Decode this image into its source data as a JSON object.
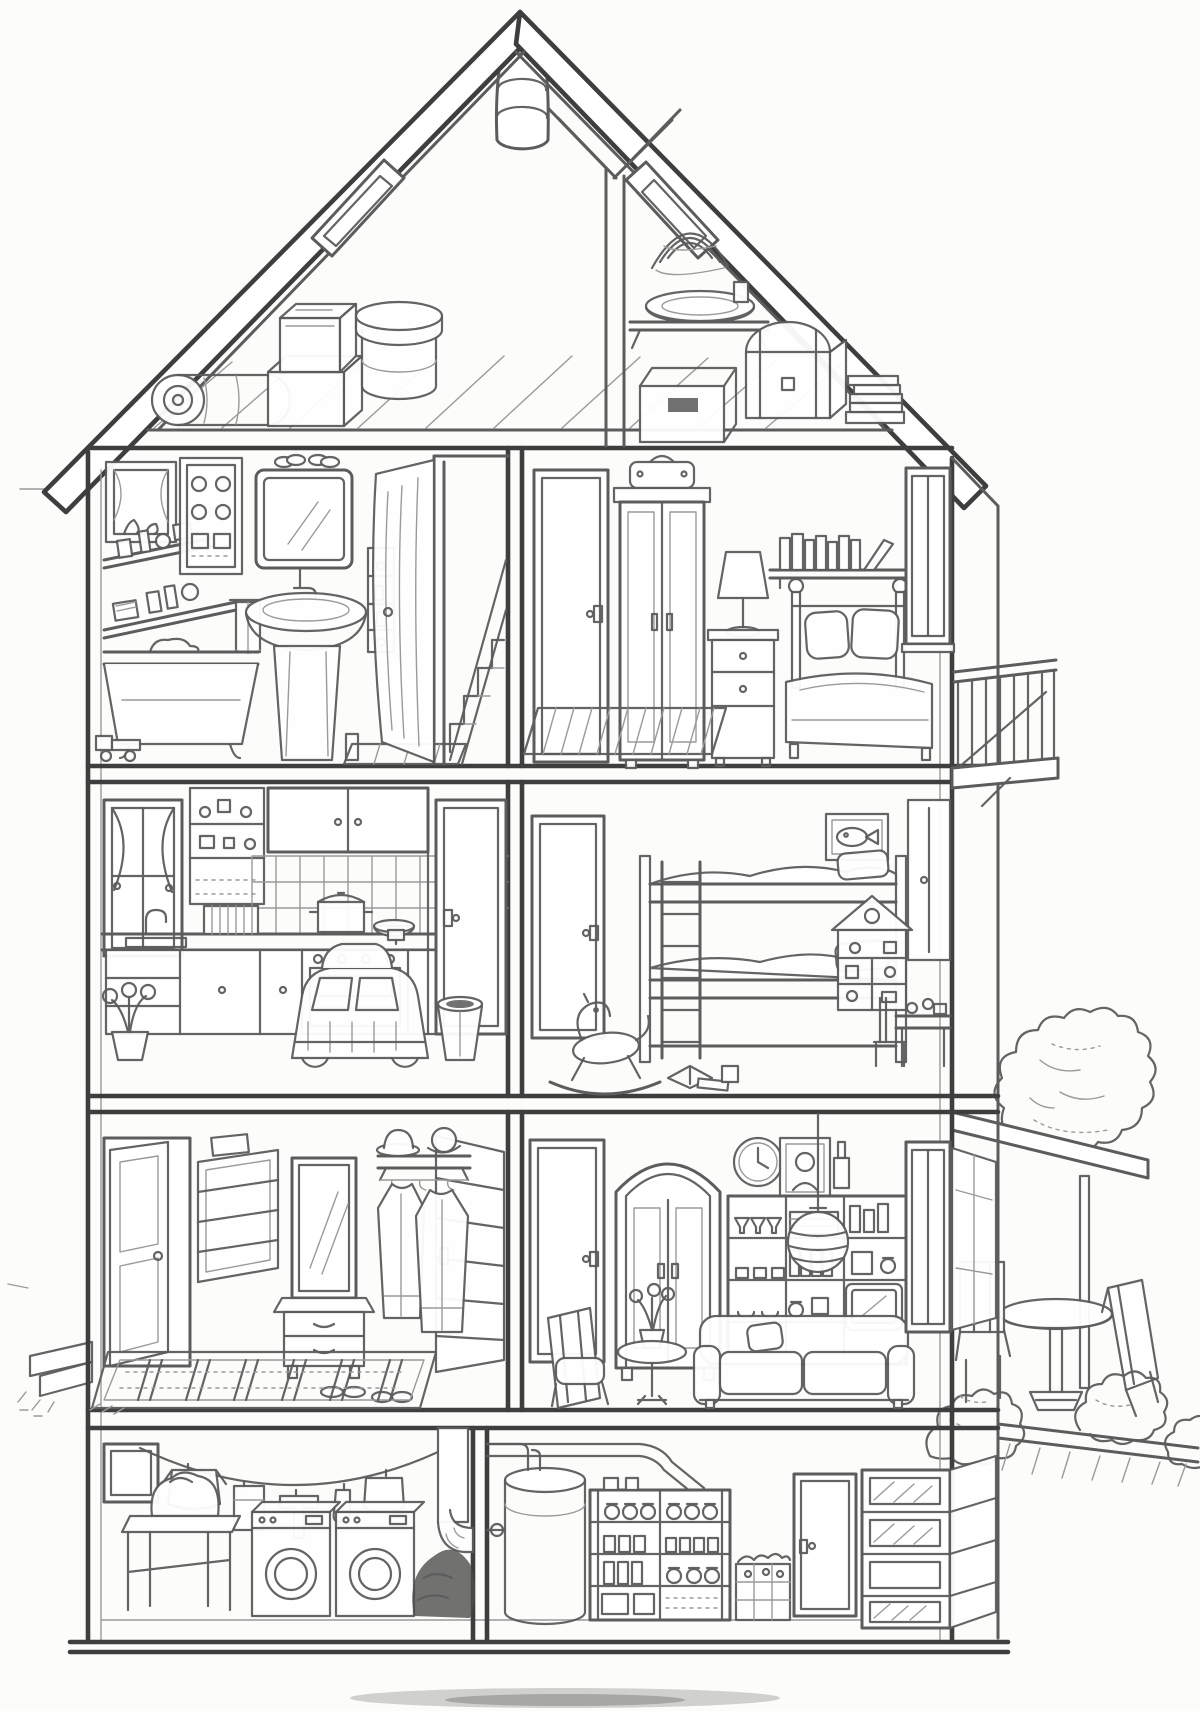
{
  "illustration": {
    "kind": "Cutaway cross-section drawing of a multi-storey dollhouse with attic and basement",
    "style": "hand-drawn black-and-white pencil line art, coloring-page style, no text",
    "palette": {
      "paper": "#fcfcfa",
      "line": "#5c5c5c",
      "line_dark": "#3e3e3e",
      "line_light": "#9a9a9a",
      "dark_fill": "#4d4d4d"
    },
    "structure": {
      "label": "House shell",
      "items": [
        "gabled-roof",
        "chimney-pipe",
        "left-skylight",
        "right-skylight",
        "double-line-walls",
        "floor-slabs",
        "room-divider-walls",
        "ground-base"
      ]
    },
    "rooms": {
      "attic": {
        "label": "Attic",
        "items": [
          "plank-floor",
          "rolled-carpet",
          "stacked-boxes",
          "round-hatbox",
          "y-roof-beam",
          "wall-shelf-with-basin",
          "straw-coil",
          "open-crate",
          "dome-lid-chest",
          "book-stacks"
        ]
      },
      "bathroom": {
        "label": "Bathroom",
        "items": [
          "window-with-plant",
          "wall-shelves-with-jars",
          "wall-cabinet",
          "mirror",
          "slippers-on-mirror",
          "towel",
          "pedestal-sink",
          "toiletry-rack",
          "bathtub",
          "toy-truck",
          "bath-mat"
        ]
      },
      "stair_landing": {
        "label": "Stair landing",
        "items": [
          "open-door",
          "staircase"
        ]
      },
      "bedroom": {
        "label": "Bedroom",
        "items": [
          "door",
          "wardrobe",
          "suitcase",
          "nightstand",
          "table-lamp",
          "book-shelf",
          "double-bed",
          "pillows",
          "window",
          "striped-rug"
        ]
      },
      "kitchen": {
        "label": "Kitchen",
        "items": [
          "window-with-curtains",
          "tall-cupboard",
          "upper-cabinets",
          "tiled-backsplash",
          "counter-with-sink",
          "dish-rack",
          "stove-with-oven",
          "cooking-pot",
          "bowl",
          "base-cabinets",
          "kitchen-door",
          "toy-pedal-car",
          "waste-bin",
          "flower-pot"
        ]
      },
      "kids_room": {
        "label": "Children's bedroom",
        "items": [
          "door",
          "bunk-bed",
          "ladder",
          "fish-picture",
          "toy-house-shelf",
          "wardrobe",
          "desk-with-toys",
          "chair",
          "rocking-horse",
          "books-on-floor"
        ]
      },
      "hallway": {
        "label": "Entrance hall",
        "items": [
          "front-door",
          "slatted-wall-rack",
          "mirror",
          "console-chest",
          "hat-shelf",
          "two-hats",
          "hanging-coats",
          "open-louvered-door",
          "shoes",
          "patterned-rug"
        ]
      },
      "living_room": {
        "label": "Living room",
        "items": [
          "door",
          "arched-cabinet",
          "wall-clock",
          "portrait-picture",
          "vase",
          "shelving-unit",
          "glasses-cups-books",
          "tv-set",
          "striped-ball-lamp",
          "armchair",
          "plant-table",
          "sofa",
          "window",
          "open-window-sash"
        ]
      },
      "laundry_room": {
        "label": "Laundry room",
        "items": [
          "small-window",
          "clothesline",
          "hanging-laundry",
          "air-duct",
          "laundry-table",
          "laundry-bag",
          "washing-machine",
          "tumble-dryer",
          "dark-laundry-pile"
        ]
      },
      "storage_room": {
        "label": "Cellar storage",
        "items": [
          "water-heater",
          "ceiling-pipes",
          "pantry-shelves",
          "preserve-jars",
          "potato-crate",
          "door",
          "crate-shelf"
        ]
      }
    },
    "exterior": {
      "label": "Garden side",
      "items": [
        "balcony",
        "entry-steps",
        "awning",
        "tree",
        "bushes",
        "patio-table",
        "patio-chair-left",
        "patio-chair-right",
        "terrace-edge",
        "ground-shadow"
      ]
    }
  }
}
